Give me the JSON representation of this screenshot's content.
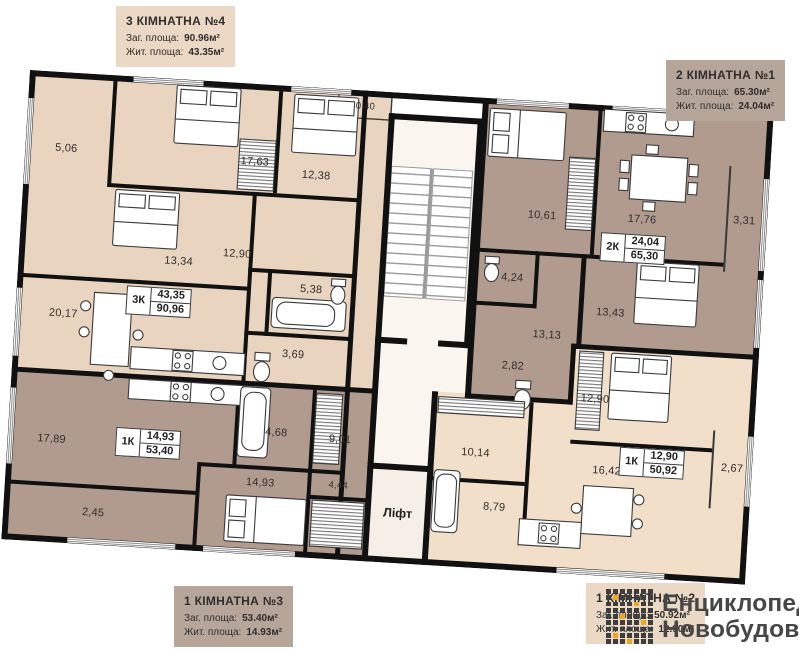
{
  "cards": {
    "apt4": {
      "title": "3 КІМНАТНА №4",
      "total_label": "Заг. площа:",
      "total_value": "90.96м²",
      "living_label": "Жит. площа:",
      "living_value": "43.35м²"
    },
    "apt1": {
      "title": "2 КІМНАТНА №1",
      "total_label": "Заг. площа:",
      "total_value": "65.30м²",
      "living_label": "Жит. площа:",
      "living_value": "24.04м²"
    },
    "apt3": {
      "title": "1 КІМНАТНА №3",
      "total_label": "Заг. площа:",
      "total_value": "53.40м²",
      "living_label": "Жит. площа:",
      "living_value": "14.93м²"
    },
    "apt2": {
      "title": "1 КІМНАТНА №2",
      "total_label": "Заг. площа:",
      "total_value": "50.92м²",
      "living_label": "Жит. площа:",
      "living_value": "12.90м²"
    }
  },
  "badges": {
    "apt4": {
      "type": "3К",
      "living": "43,35",
      "total": "90,96"
    },
    "apt1": {
      "type": "2К",
      "living": "24,04",
      "total": "65,30"
    },
    "apt3": {
      "type": "1К",
      "living": "14,93",
      "total": "53,40"
    },
    "apt2": {
      "type": "1К",
      "living": "12,90",
      "total": "50,92"
    }
  },
  "rooms": {
    "r5_06": "5,06",
    "r17_63": "17,63",
    "r12_38": "12,38",
    "r0_40": "0,40",
    "r13_34": "13,34",
    "r12_90_hall": "12,90",
    "r5_38": "5,38",
    "r20_17": "20,17",
    "r3_69": "3,69",
    "r17_89": "17,89",
    "r2_45": "2,45",
    "r14_93": "14,93",
    "r4_44": "4,44",
    "r9_01": "9,01",
    "r4_68": "4,68",
    "r10_61": "10,61",
    "r17_76": "17,76",
    "r3_31": "3,31",
    "r4_24": "4,24",
    "r13_13": "13,13",
    "r2_82": "2,82",
    "r13_43": "13,43",
    "r12_90_bed": "12,90",
    "r2_67": "2,67",
    "r16_42": "16,42",
    "r10_14": "10,14",
    "r8_79": "8,79"
  },
  "lift_label": "Ліфт",
  "watermark": {
    "line1": "Енциклопедія",
    "line2": "Новобудов"
  },
  "colors": {
    "apartment_beige": "#e9d4bf",
    "apartment_mauve": "#b19b8f",
    "apartment_light": "#f2dfca",
    "card_beige": "#ecd9c5",
    "card_mauve": "#b6a69a",
    "wall": "#111111",
    "logo_dark": "#3e3e3e",
    "logo_accent": "#f2a71b"
  }
}
